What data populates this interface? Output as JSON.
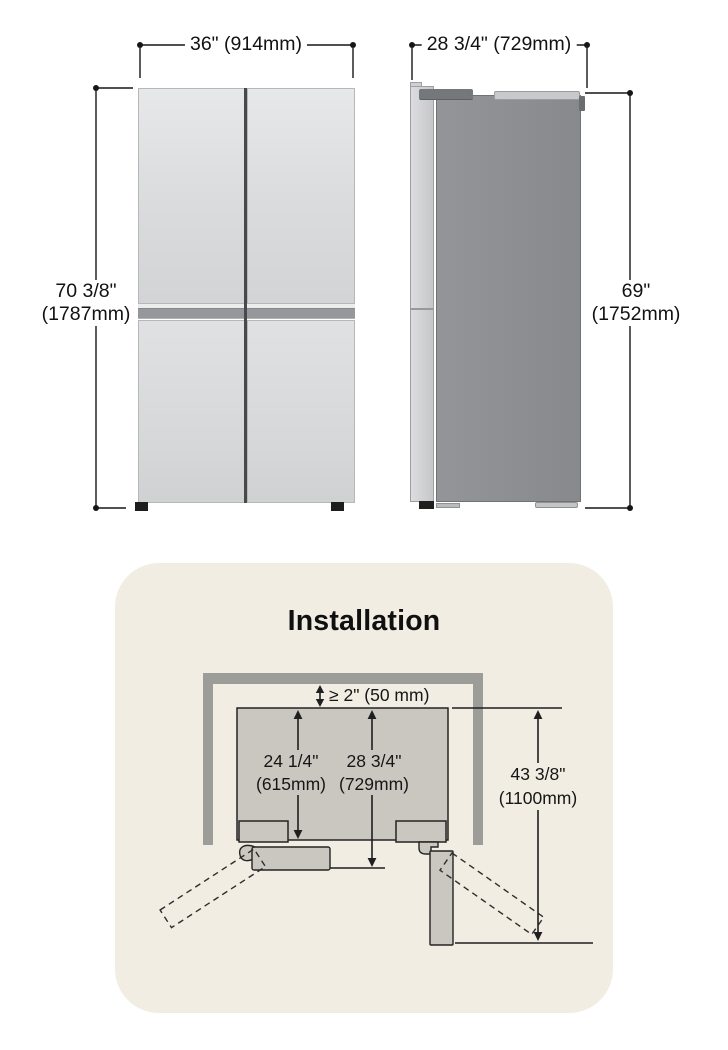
{
  "front_view": {
    "width_label": "36\" (914mm)",
    "height_label": [
      "70 3/8\"",
      "(1787mm)"
    ]
  },
  "side_view": {
    "depth_label": "28 3/4\" (729mm)",
    "height_label": [
      "69\"",
      "(1752mm)"
    ]
  },
  "installation": {
    "title": "Installation",
    "clearance_label": "≥ 2\" (50 mm)",
    "cabinet_depth_label": [
      "24 1/4\"",
      "(615mm)"
    ],
    "depth_with_door_label": [
      "28 3/4\"",
      "(729mm)"
    ],
    "door_open_depth_label": [
      "43 3/8\"",
      "(1100mm)"
    ]
  },
  "colors": {
    "page_background": "#ffffff",
    "panel_background": "#f1ede3",
    "wall_gray": "#9c9c98",
    "diagram_fill_gray": "#c9c7c0",
    "line_color": "#1f1f1f"
  }
}
